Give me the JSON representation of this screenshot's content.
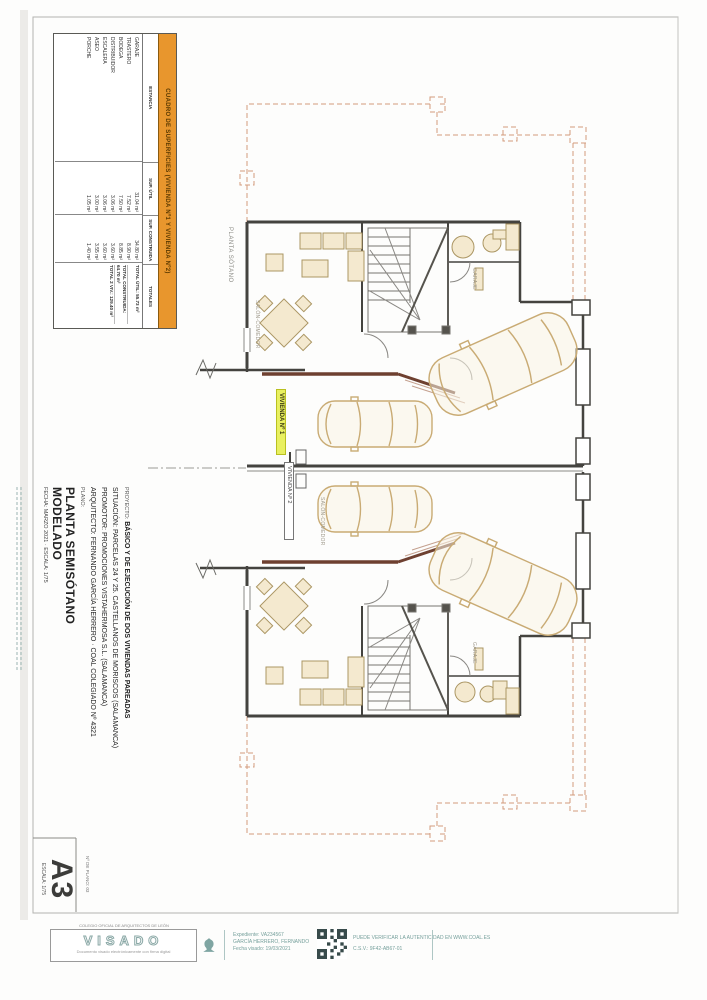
{
  "page": {
    "format_label": "A3",
    "scale_label": "ESCALA: 1/75",
    "plan_number_label": "Nº DE PLANO: 03"
  },
  "areas_table": {
    "title": "CUADRO DE SUPERFICIES (VIVIENDA Nº1 Y VIVIENDA Nº2)",
    "col_headers": [
      "ESTANCIA",
      "SUP. ÚTIL",
      "SUP. CONSTRUIDA",
      "TOTALES"
    ],
    "rows": [
      {
        "name": "GARAJE",
        "util": "31.04 m²",
        "built": "34.80 m²"
      },
      {
        "name": "TRASTERO",
        "util": "7.52 m²",
        "built": "8.90 m²"
      },
      {
        "name": "BODEGA",
        "util": "7.50 m²",
        "built": "8.85 m²"
      },
      {
        "name": "DISTRIBUIDOR",
        "util": "3.06 m²",
        "built": "3.60 m²"
      },
      {
        "name": "ESCALERA",
        "util": "3.06 m²",
        "built": "3.60 m²"
      },
      {
        "name": "ASEO",
        "util": "3.00 m²",
        "built": "3.55 m²"
      },
      {
        "name": "PORCHE",
        "util": "1.05 m²",
        "built": "1.40 m²"
      }
    ],
    "totals": [
      "TOTAL ÚTIL: 55.73 m²",
      "TOTAL CONSTRUIDA: 64.70 m²",
      "TOTAL 2 VIV.: 129.40 m²"
    ]
  },
  "title_block": {
    "project_label": "PROYECTO:",
    "project": "BÁSICO Y DE EJECUCIÓN DE DOS VIVIENDAS PAREADAS",
    "situation": "SITUACIÓN: PARCELAS 24 Y 25. CASTELLANOS DE MORISCOS (SALAMANCA)",
    "promoter": "PROMOTOR: PROMOCIONES VISTAHERMOSA S.L. (SALAMANCA)",
    "architect": "ARQUITECTO: FERNANDO GARCÍA HERRERO · COAL COLEGIADO Nº 4321",
    "plan_label": "PLANO:",
    "plan_name_1": "PLANTA SEMISÓTANO",
    "plan_name_2": "MODELADO",
    "meta": "FECHA: MARZO 2021 · ESCALA: 1/75"
  },
  "plan_labels": {
    "floor": "PLANTA SÓTANO",
    "unit1": "VIVIENDA Nº 1",
    "unit2": "VIVIENDA Nº 2",
    "living_upper": "SALÓN-COMEDOR",
    "living_lower": "SALÓN-COMEDOR",
    "garage_upper": "GARAJE",
    "garage_lower": "GARAJE"
  },
  "stamp": {
    "brand": "VISADO",
    "box_top": "COLEGIO OFICIAL DE ARQUITECTOS DE LEÓN",
    "box_bottom": "Documento visado electrónicamente con firma digital",
    "expediente": "Expediente: VA234567",
    "colegiado": "GARCÍA HERRERO, FERNANDO",
    "fecha": "Fecha visado: 19/03/2021",
    "verify1": "PUEDE VERIFICAR LA AUTENTICIDAD EN WWW.COAL.ES",
    "verify2": "C.S.V.: 9F42-AB67-01"
  }
}
